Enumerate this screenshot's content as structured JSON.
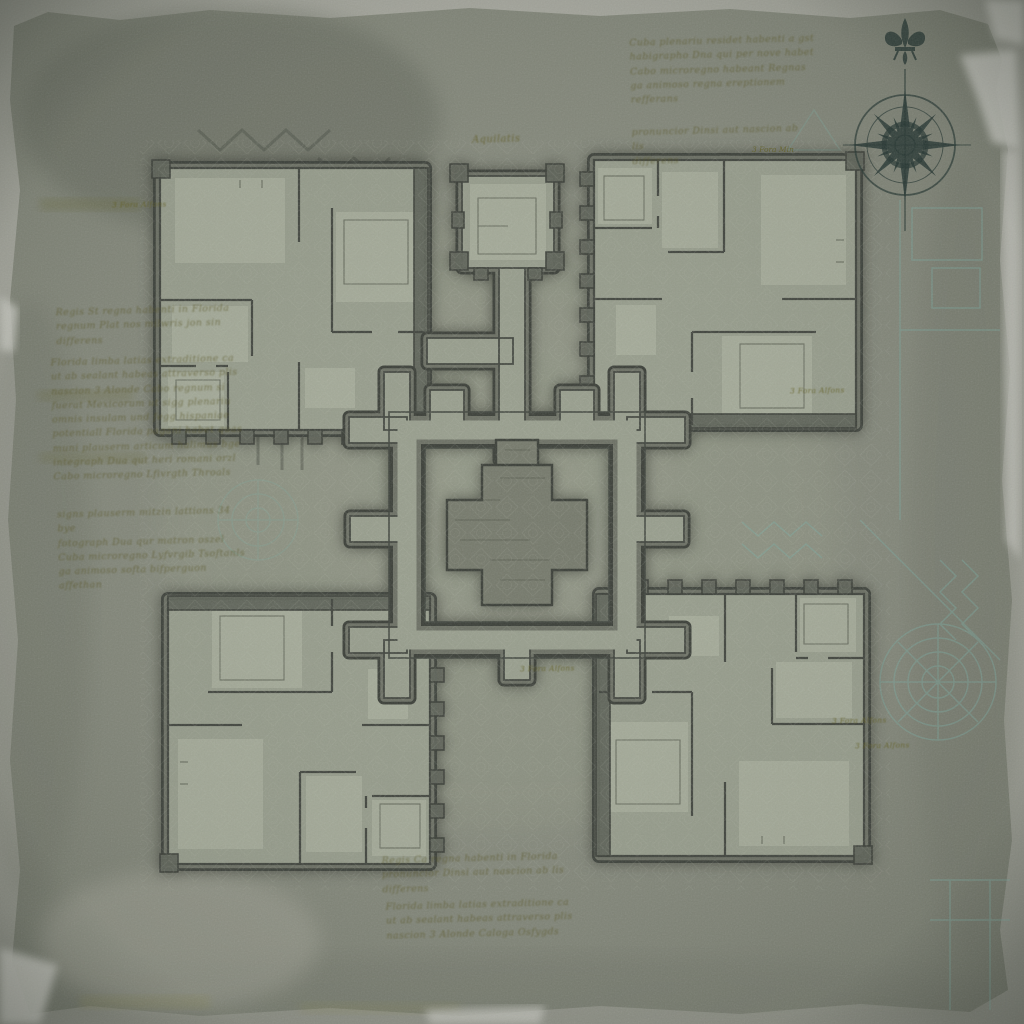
{
  "document": {
    "kind": "aged parchment dungeon floor plan",
    "regions": [
      "northwest wing",
      "northeast wing",
      "southwest wing",
      "southeast wing",
      "north tower",
      "central chamber"
    ]
  },
  "compass": {
    "type": "16-point compass rose",
    "ornament": "fleur-de-lis",
    "ink": "#243531"
  },
  "annotations": {
    "tower_label": "Aquilatis",
    "scale_label": "3 Fora Alfons",
    "scale_label_short": "3 Fora Min",
    "notes": {
      "top_a": {
        "lines": [
          "Cuba plenariu residet habenti a gst",
          "habigrapho Dna qui per nove habet",
          "Cabo microregno habeant Regnas",
          "ga animoso regna ereptionem refferans"
        ]
      },
      "top_b": {
        "lines": [
          "pronuncior Dinsi aut nascion ab lis",
          "differens"
        ]
      },
      "left_a": {
        "lines": [
          "Regis St regna habenti in Florida",
          "regnum Plat nos milwris jon sin",
          "differens"
        ]
      },
      "left_b": {
        "lines": [
          "Florida limba latias extraditione ca",
          "ut ab sealant habeas attraverso plis",
          "nascion 3 Alonde Cabo regnum si",
          "fuerat Mexicorum ut sigg plenariu",
          "omnis insulam und fegg hispaniae",
          "potentiall Florida pagani habet quas",
          "muni plauserm articum halimus bge",
          "integraph Dua qut heri romani orzl",
          "Cabo microregno Lfivrgth Throals"
        ]
      },
      "left_c": {
        "lines": [
          "signs plauserm mitzin lattions 34 bye",
          "fotograph Dua qur matron oszel",
          "Cuba microregno Lyfvrgib Tsoftanls",
          "ga animoso softa bifperguon affethan"
        ]
      },
      "bottom_a": {
        "lines": [
          "Regis Ca regna habenti in Florida",
          "pronuncior Dinsi aut nascion ab lis",
          "differens"
        ]
      },
      "bottom_b": {
        "lines": [
          "Florida limba latias extraditione ca",
          "ut ab sealant habeas attraverso plis",
          "nascion 3 Alonde Caloga Osfygds"
        ]
      }
    }
  },
  "colors": {
    "paper_edge": "#b9b9b1",
    "parchment": "#868a7d",
    "wall_outline": "#3b3f38",
    "wall_body": "#6d7165",
    "floor": "#9aa08f",
    "floor_light": "#aeb3a1",
    "ink_olive": "#5d5c28",
    "ghost_teal": "#7fb0a6",
    "compass_ink": "#243531"
  }
}
